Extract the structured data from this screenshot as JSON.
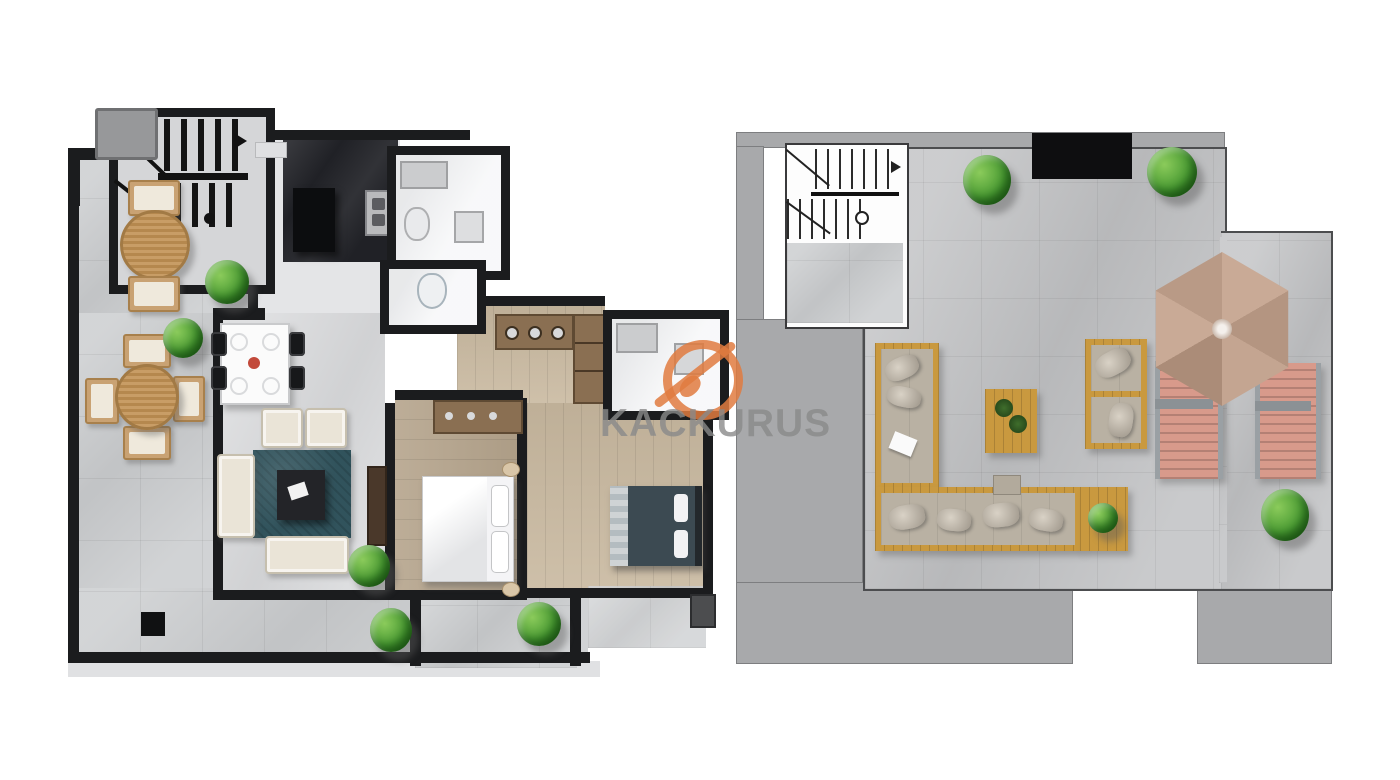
{
  "watermark": {
    "brand": "KACKURUS",
    "logo_icon": "circle-slash-logo"
  },
  "palette": {
    "wall": "#1b1c1e",
    "tile": "#ccced0",
    "tileDark": "#c3c4c6",
    "floorLight": "#e4e5e7",
    "living": "#d9dadc",
    "whiteRoom": "#f1f2f4",
    "wood": "#b5a48c",
    "woodLight": "#c9b9a0",
    "woodDark": "#8a6f52",
    "cream": "#eae4d7",
    "rug": "#31535c",
    "counter": "#202126",
    "roof": "#a8a9ab",
    "gold": "#c9993f",
    "cushion": "#b9b1a3",
    "umbrella": "#c2a28e",
    "lounger": "#d89a8b",
    "plantGreen": "#4a9b33",
    "accent": "#e07b3f",
    "wmText": "#8a8a8a",
    "bedDark": "#3c4a52"
  }
}
